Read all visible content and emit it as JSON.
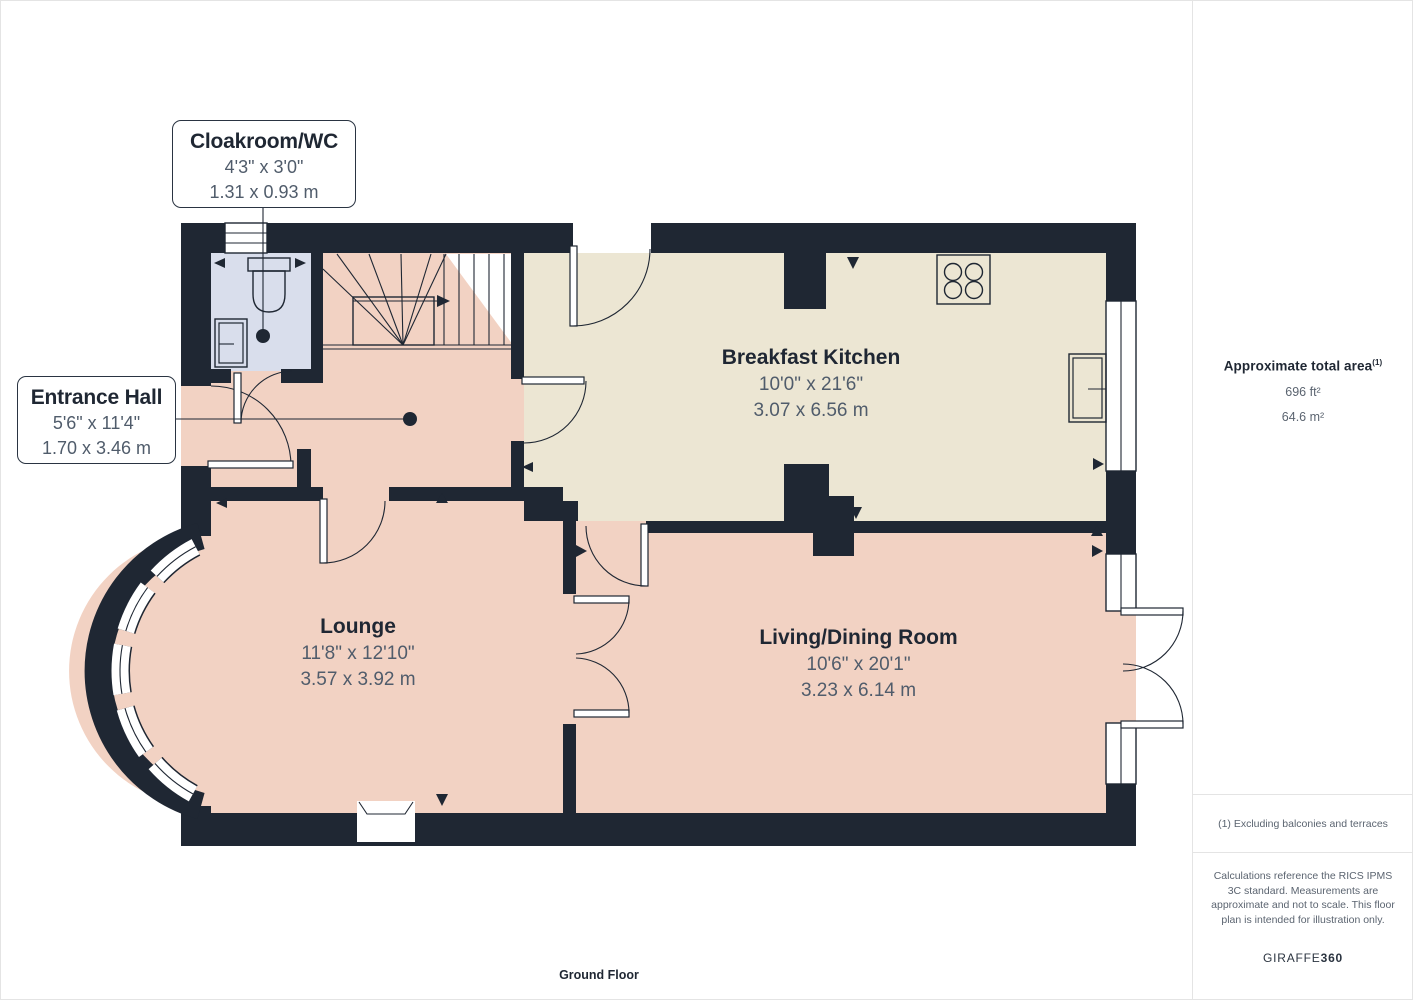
{
  "plan": {
    "floor_label": "Ground Floor",
    "rooms": {
      "cloakroom": {
        "name": "Cloakroom/WC",
        "imperial": "4'3\" x 3'0\"",
        "metric": "1.31 x 0.93 m"
      },
      "entrance_hall": {
        "name": "Entrance Hall",
        "imperial": "5'6\" x 11'4\"",
        "metric": "1.70 x 3.46 m"
      },
      "breakfast_kitchen": {
        "name": "Breakfast Kitchen",
        "imperial": "10'0\" x 21'6\"",
        "metric": "3.07 x 6.56 m"
      },
      "lounge": {
        "name": "Lounge",
        "imperial": "11'8\" x 12'10\"",
        "metric": "3.57 x 3.92 m"
      },
      "living_dining": {
        "name": "Living/Dining Room",
        "imperial": "10'6\" x 20'1\"",
        "metric": "3.23 x 6.14 m"
      }
    },
    "colors": {
      "wall": "#1F2733",
      "pink": "#F2D2C3",
      "cream": "#ECE6D3",
      "blue": "#D9DEEC",
      "title-text": "#1F2733",
      "dim-text": "#505C6B",
      "muted": "#5B6470",
      "line": "#E4E4E4"
    }
  },
  "sidebar": {
    "area_title": "Approximate total area",
    "area_sup": "(1)",
    "area_ft": "696 ft²",
    "area_m": "64.6 m²",
    "footnote": "(1) Excluding balconies and terraces",
    "disclaimer": "Calculations reference the RICS IPMS 3C standard. Measurements are approximate and not to scale. This floor plan is intended for illustration only.",
    "brand_name": "GIRAFFE",
    "brand_number": "360"
  }
}
